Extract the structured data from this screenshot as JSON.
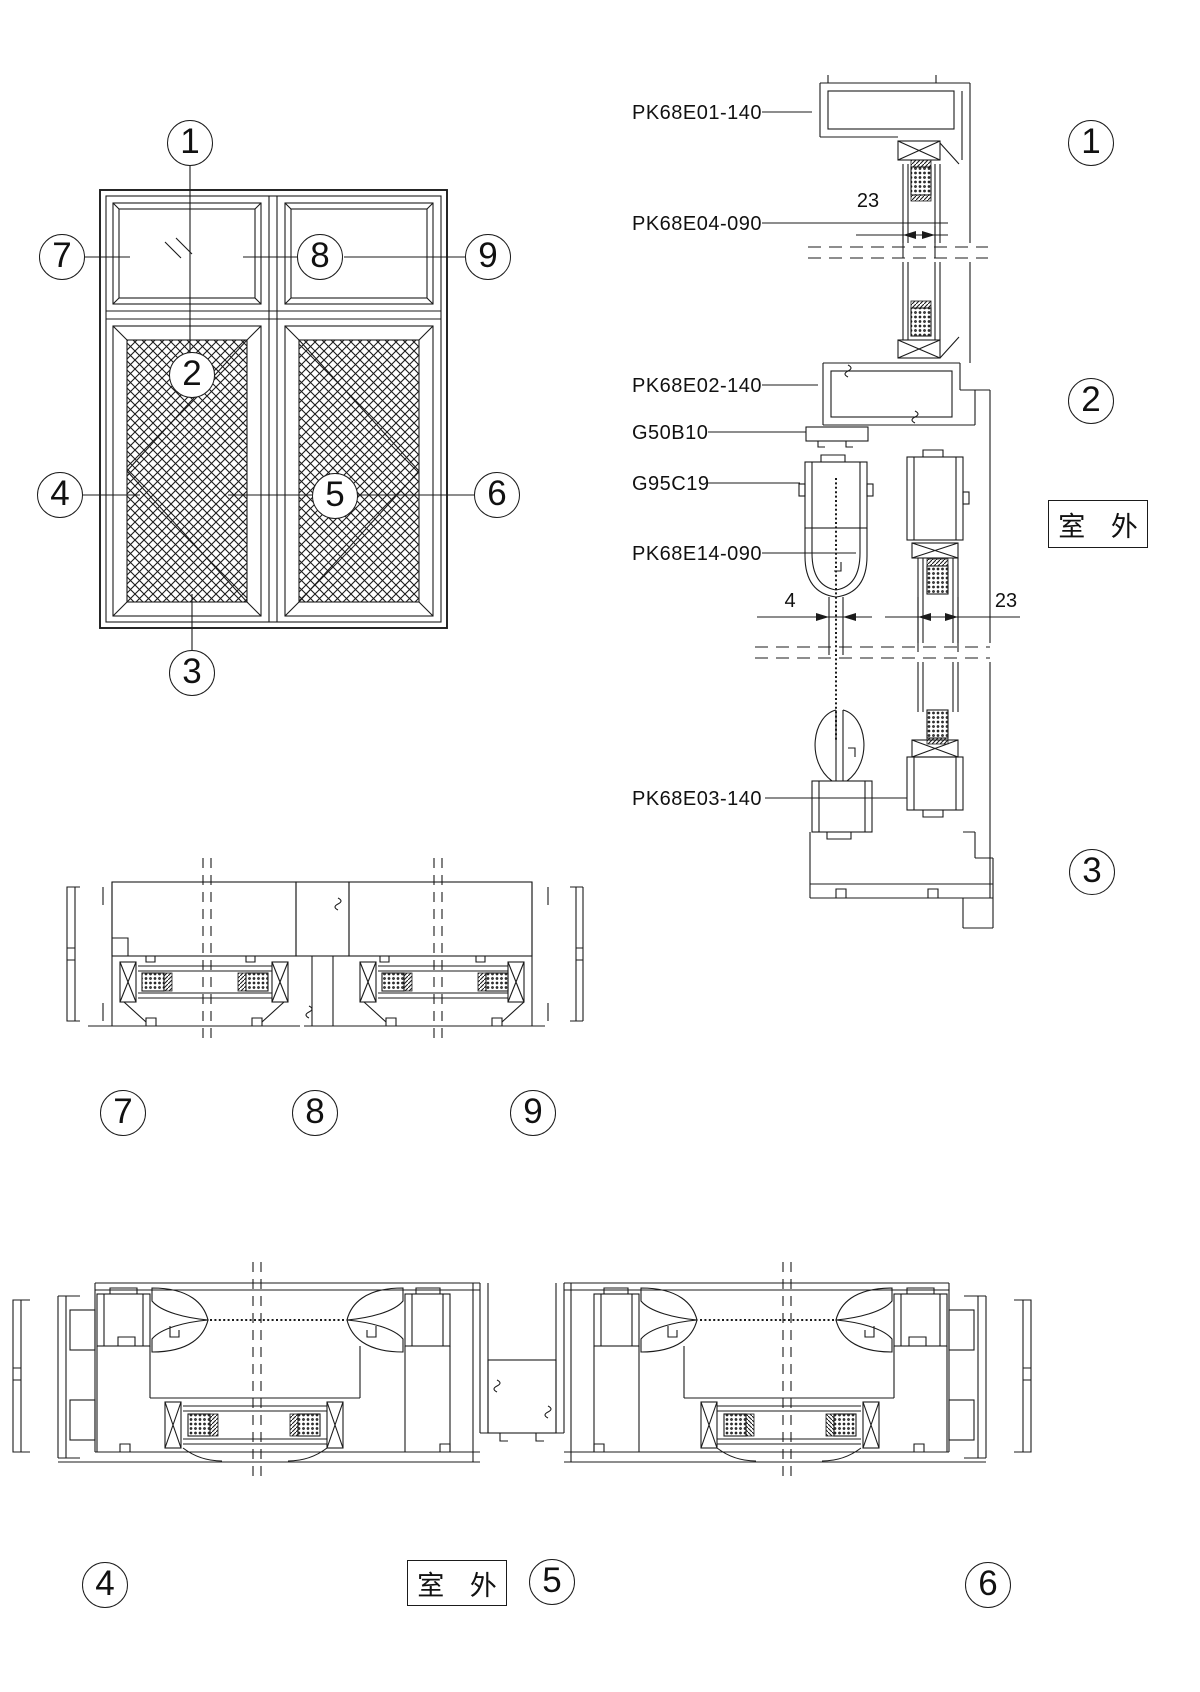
{
  "elevation": {
    "callouts": {
      "n1": "1",
      "n2": "2",
      "n3": "3",
      "n4": "4",
      "n5": "5",
      "n6": "6",
      "n7": "7",
      "n8": "8",
      "n9": "9"
    }
  },
  "vertical_section": {
    "part_labels": [
      {
        "text": "PK68E01-140"
      },
      {
        "text": "PK68E04-090"
      },
      {
        "text": "PK68E02-140"
      },
      {
        "text": "G50B10"
      },
      {
        "text": "G95C19"
      },
      {
        "text": "PK68E14-090"
      },
      {
        "text": "PK68E03-140"
      }
    ],
    "dimensions": {
      "glass_top": "23",
      "seal_gap": "4",
      "glass_mid": "23"
    },
    "outdoor_label": "室 外",
    "bubbles": {
      "n1": "1",
      "n2": "2",
      "n3": "3"
    }
  },
  "head_section": {
    "bubbles": {
      "n7": "7",
      "n8": "8",
      "n9": "9"
    }
  },
  "sill_section": {
    "bubbles": {
      "n4": "4",
      "n5": "5",
      "n6": "6"
    },
    "outdoor_label": "室 外"
  }
}
